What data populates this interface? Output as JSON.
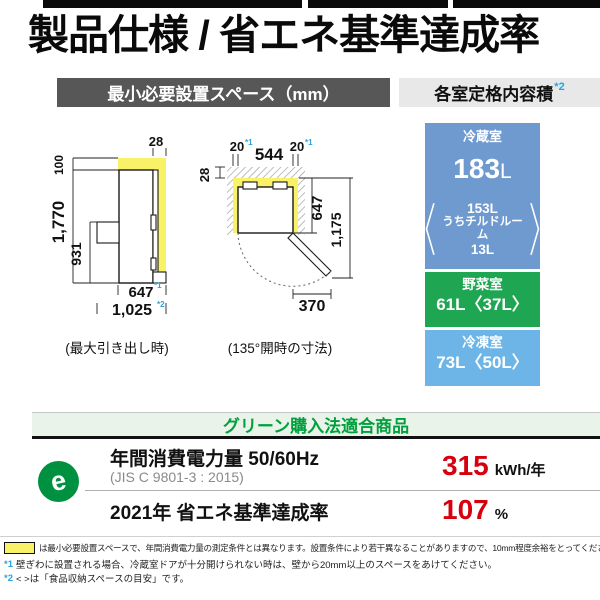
{
  "page": {
    "title": "製品仕様 / 省エネ基準達成率"
  },
  "install_section": {
    "header": "最小必要設置スペース（mm）",
    "side_view": {
      "caption": "(最大引き出し時)",
      "dim_top_clearance": "28",
      "dim_above": "100",
      "dim_height": "1,770",
      "dim_drawer_height": "931",
      "dim_depth": "647",
      "dim_depth_note": "*1",
      "dim_total_depth": "1,025",
      "dim_total_depth_note": "*2"
    },
    "top_view": {
      "caption": "(135°開時の寸法)",
      "dim_gap_left": "20",
      "dim_gap_left_note": "*1",
      "dim_width": "544",
      "dim_gap_right": "20",
      "dim_gap_right_note": "*1",
      "dim_back_clearance": "28",
      "dim_body_depth": "647",
      "dim_open_depth": "1,175",
      "dim_door_swing": "370"
    }
  },
  "capacity_section": {
    "header": "各室定格内容積",
    "header_note": "*2",
    "rooms": [
      {
        "name": "冷蔵室",
        "value": "183",
        "unit": "L",
        "sub_lines": [
          "153L",
          "うちチルドルーム",
          "13L"
        ]
      },
      {
        "name": "野菜室",
        "value": "61L〈37L〉"
      },
      {
        "name": "冷凍室",
        "value": "73L〈50L〉"
      }
    ]
  },
  "green_section": {
    "header": "グリーン購入法適合商品",
    "icon_letter": "e",
    "row1": {
      "label": "年間消費電力量 50/60Hz",
      "sub": "(JIS C 9801-3 : 2015)",
      "value": "315",
      "unit": "kWh/年"
    },
    "row2": {
      "label": "2021年 省エネ基準達成率",
      "value": "107",
      "unit": "%"
    }
  },
  "footnotes": {
    "note1": "は最小必要設置スペースで、年間消費電力量の測定条件とは異なります。設置条件により若干異なることがありますので、10mm程度余裕をとってください。",
    "note2_mark": "*1",
    "note2": "壁ぎわに設置される場合、冷蔵室ドアが十分開けられない時は、壁から20mm以上のスペースをあけてください。",
    "note3_mark": "*2",
    "note3": "< >は「食品収納スペースの目安」です。"
  },
  "colors": {
    "fridge_room_blue": "#6f9ad0",
    "veg_room_green": "#1fa652",
    "freezer_room_blue": "#6cb5e6",
    "highlight_yellow": "#f9f269",
    "accent_red": "#d7000f",
    "green_text": "#00a03c",
    "note_blue": "#2ba3dc"
  }
}
